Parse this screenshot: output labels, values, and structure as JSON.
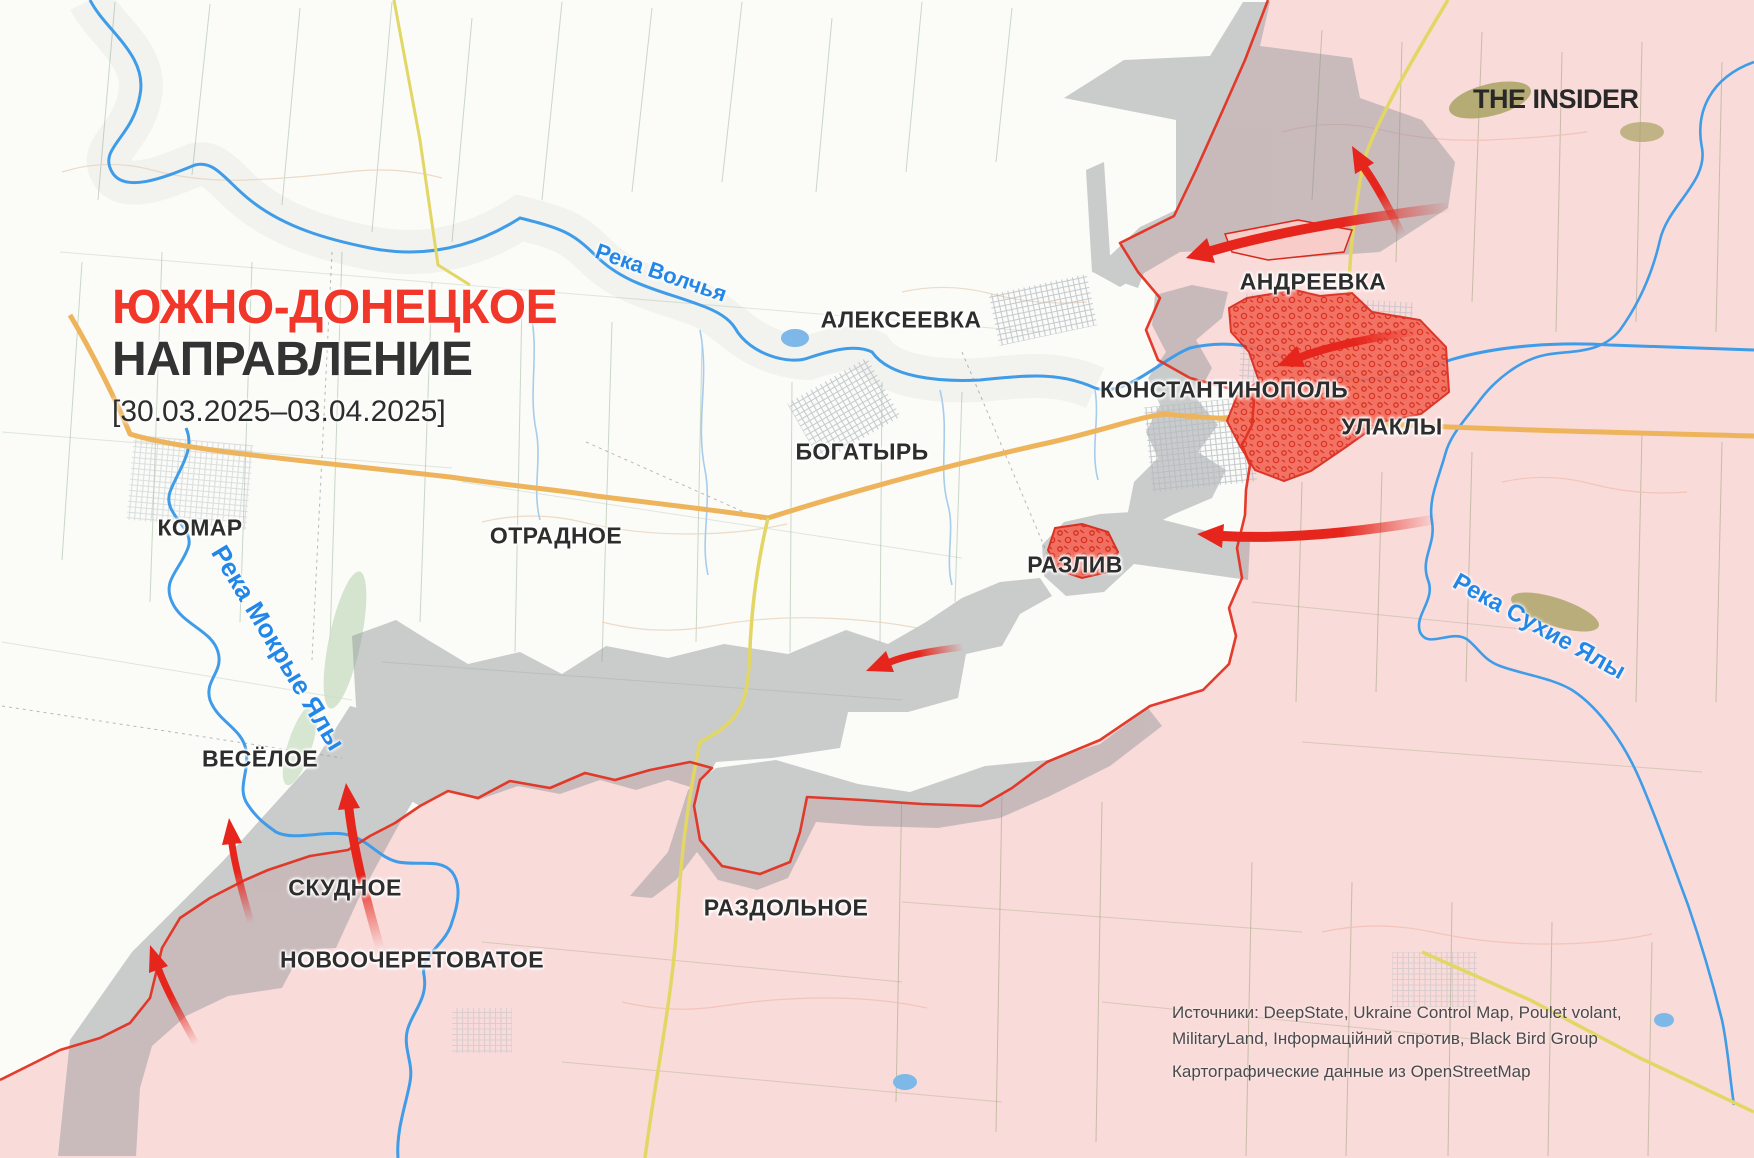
{
  "header": {
    "title_line1": "ЮЖНО-ДОНЕЦКОЕ",
    "title_line2": "НАПРАВЛЕНИЕ",
    "date_range": "[30.03.2025–03.04.2025]",
    "logo": "THE INSIDER"
  },
  "towns": [
    {
      "name": "КОМАР"
    },
    {
      "name": "АЛЕКСЕЕВКА"
    },
    {
      "name": "БОГАТЫРЬ"
    },
    {
      "name": "ОТРАДНОЕ"
    },
    {
      "name": "АНДРЕЕВКА"
    },
    {
      "name": "КОНСТАНТИНОПОЛЬ"
    },
    {
      "name": "УЛАКЛЫ"
    },
    {
      "name": "РАЗЛИВ"
    },
    {
      "name": "ВЕСЁЛОЕ"
    },
    {
      "name": "СКУДНОЕ"
    },
    {
      "name": "НОВООЧЕРЕТОВАТОЕ"
    },
    {
      "name": "РАЗДОЛЬНОЕ"
    }
  ],
  "rivers": [
    {
      "name": "Река Волчья"
    },
    {
      "name": "Река Мокрые Ялы"
    },
    {
      "name": "Река Сухие Ялы"
    }
  ],
  "attribution": {
    "sources_line1": "Источники: DeepState, Ukraine Control Map, Poulet volant,",
    "sources_line2": "MilitaryLand, Інформаційний спротив, Black Bird Group",
    "map_data": "Картографические данные из OpenStreetMap"
  },
  "legend_colors": {
    "title_accent": "#f0372a",
    "occupied_area": "#f9dbda",
    "contested_gray_zone": "#8f9396",
    "recent_advance": "#f36a5a",
    "front_line": "#e23222",
    "attack_arrow": "#e6251c",
    "river": "#3f9ce8",
    "road_primary": "#eeb45c",
    "road_secondary": "#e2d765"
  }
}
